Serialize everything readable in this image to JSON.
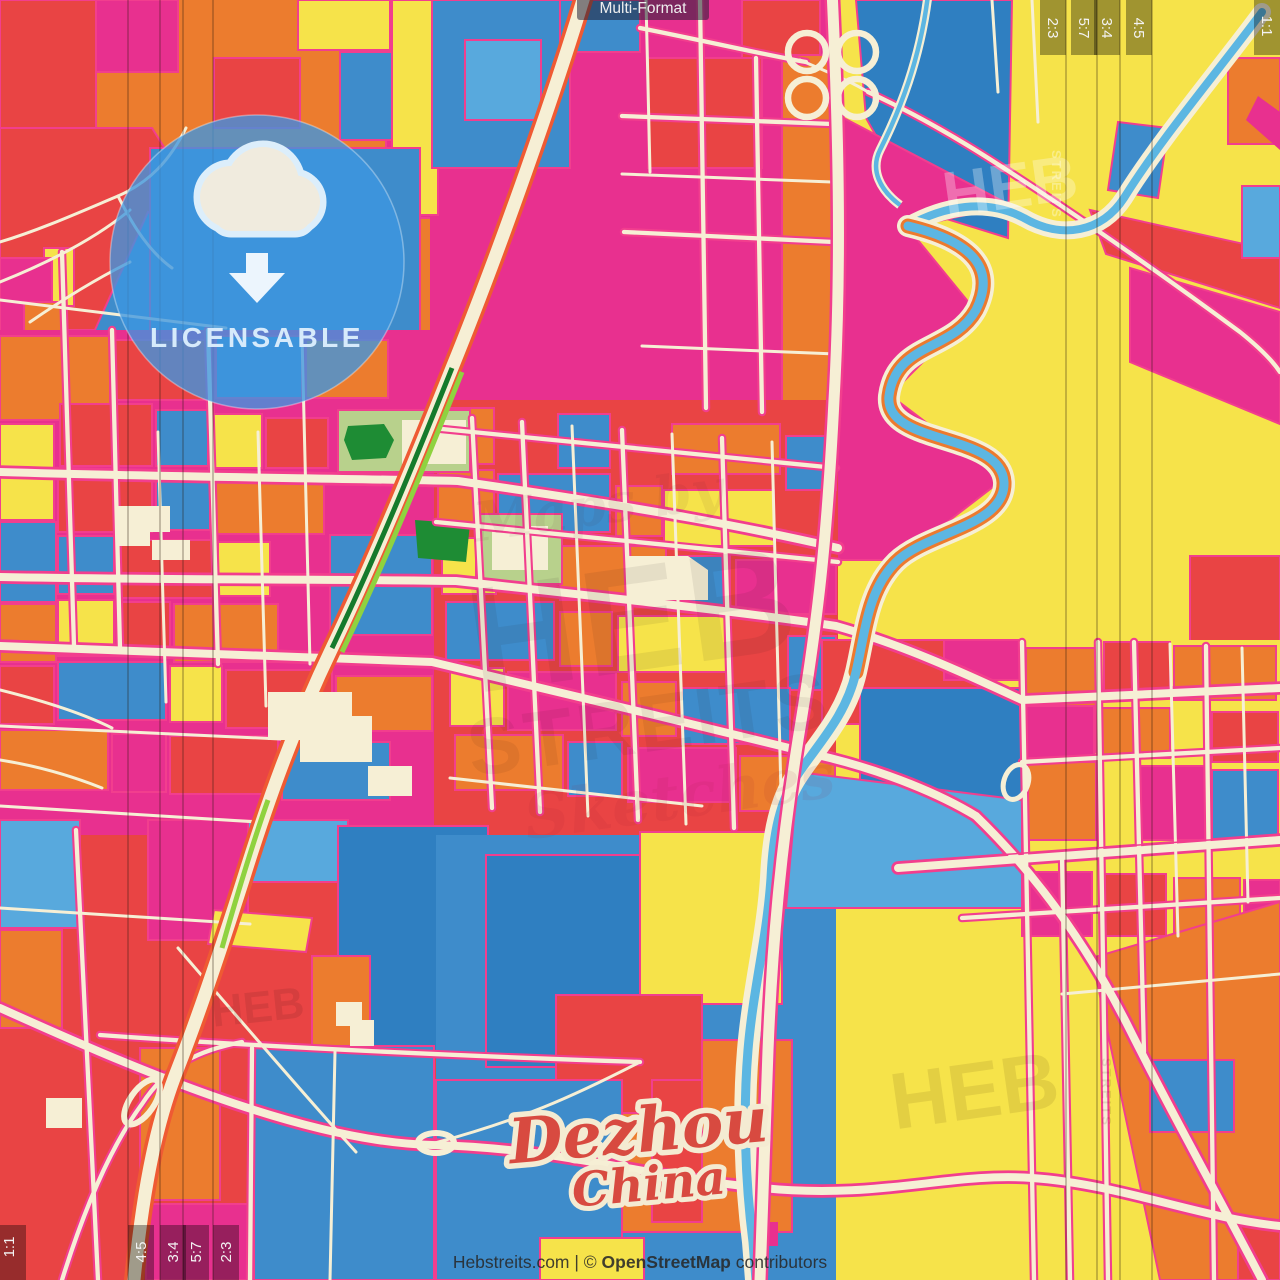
{
  "header": {
    "format_badge": "Multi-Format"
  },
  "license_badge": {
    "label": "LICENSABLE",
    "icon": "cloud-download-icon"
  },
  "map_label": {
    "city": "Dezhou",
    "country": "China"
  },
  "attribution": {
    "pre": "Hebstreits.com | © ",
    "osm": "OpenStreetMap",
    "suffix": " contributors"
  },
  "ratio_overlay": {
    "top_labels": [
      "2:3",
      "5:7",
      "3:4",
      "4:5"
    ],
    "top_corner": "1:1",
    "bottom_labels": [
      "4:5",
      "3:4",
      "5:7",
      "2:3"
    ],
    "bottom_corner": "1:1"
  },
  "watermarks": {
    "center_top": "Maps by",
    "center_main": "HEB",
    "center_sub": "STREITS",
    "center_script": "Sketches",
    "top_right": "HEB",
    "top_right_side": "STREITS",
    "bottom_right": "HEB",
    "bottom_right_side": "STREITS",
    "bottom_left": "HEB"
  },
  "colors": {
    "red": "#e94444",
    "orange": "#ec7c2e",
    "yellow": "#f6e34a",
    "blue": "#3e8ccb",
    "light_blue": "#58a9dd",
    "deep_blue": "#2f7fc1",
    "magenta": "#e8308f",
    "street_cream": "#f6efd5",
    "street_casing_pink": "#f23e8e",
    "river_blue": "#5cb6e2",
    "park_green": "#b8d18c",
    "dark_green": "#1e8c34",
    "badge_blue": "#3d96e0",
    "city_label_red": "#d84a40",
    "city_label_outline": "#f4ebd2"
  }
}
